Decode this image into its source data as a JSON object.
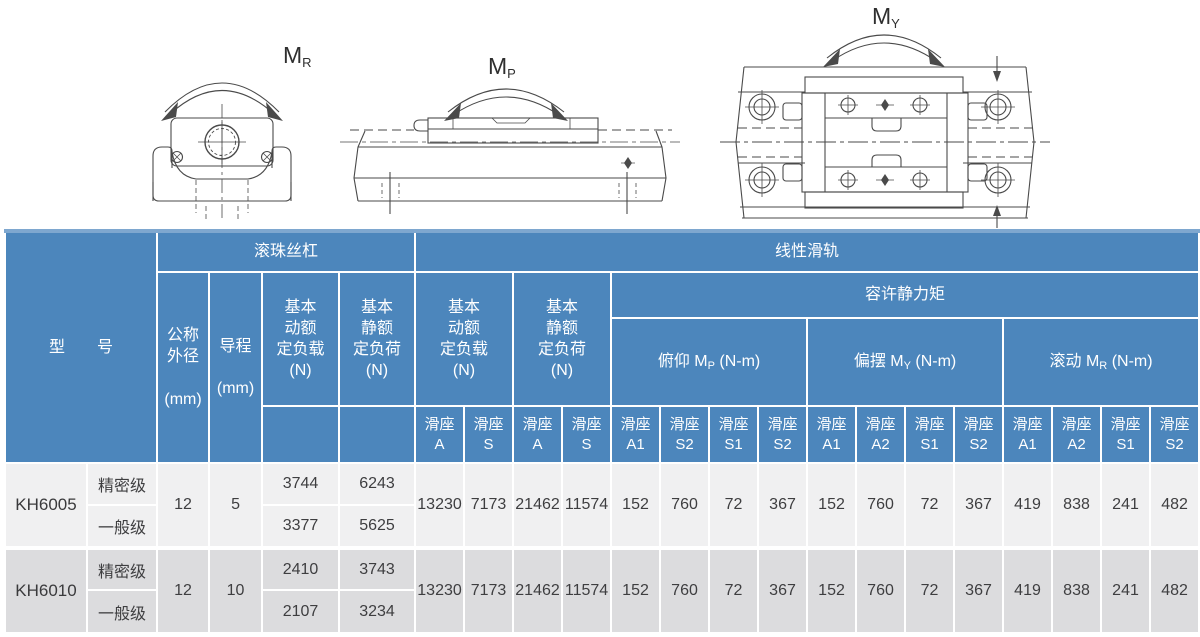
{
  "diagrams": {
    "mr": {
      "prefix": "M",
      "sub": "R"
    },
    "mp": {
      "prefix": "M",
      "sub": "P"
    },
    "my": {
      "prefix": "M",
      "sub": "Y"
    }
  },
  "colors": {
    "header_blue": "#4c86bc",
    "header_top_strip": "#7ea7cf",
    "row_light_gray": "#f0f0f1",
    "row_dark_gray": "#dcdcde",
    "body_text": "#3e3e40",
    "drawing_line": "#4a4a4a"
  },
  "table": {
    "header": {
      "model": "型　　号",
      "ball_screw": "滚珠丝杠",
      "linear_guide": "线性滑轨",
      "nominal_od": "公称\n外径\n\n(mm)",
      "lead": "导程\n\n(mm)",
      "bs_dynamic": "基本\n动额\n定负载\n(N)",
      "bs_static": "基本\n静额\n定负荷\n(N)",
      "lg_dynamic": "基本\n动额\n定负载\n(N)",
      "lg_static": "基本\n静额\n定负荷\n(N)",
      "static_moment": "容许静力矩",
      "moment_groups": [
        {
          "prefix": "俯仰 M",
          "sub": "P",
          "suffix": " (N-m)"
        },
        {
          "prefix": "偏摆 M",
          "sub": "Y",
          "suffix": " (N-m)"
        },
        {
          "prefix": "滚动 M",
          "sub": "R",
          "suffix": " (N-m)"
        }
      ],
      "slide_cols": [
        {
          "top": "滑座",
          "bottom": "A"
        },
        {
          "top": "滑座",
          "bottom": "S"
        },
        {
          "top": "滑座",
          "bottom": "A"
        },
        {
          "top": "滑座",
          "bottom": "S"
        },
        {
          "top": "滑座",
          "bottom": "A1"
        },
        {
          "top": "滑座",
          "bottom": "S2"
        },
        {
          "top": "滑座",
          "bottom": "S1"
        },
        {
          "top": "滑座",
          "bottom": "S2"
        },
        {
          "top": "滑座",
          "bottom": "A1"
        },
        {
          "top": "滑座",
          "bottom": "A2"
        },
        {
          "top": "滑座",
          "bottom": "S1"
        },
        {
          "top": "滑座",
          "bottom": "S2"
        },
        {
          "top": "滑座",
          "bottom": "A1"
        },
        {
          "top": "滑座",
          "bottom": "A2"
        },
        {
          "top": "滑座",
          "bottom": "S1"
        },
        {
          "top": "滑座",
          "bottom": "S2"
        }
      ]
    },
    "rows": [
      {
        "model": "KH6005",
        "od": "12",
        "lead": "5",
        "grades": [
          {
            "grade": "精密级",
            "bs_dyn": "3744",
            "bs_stat": "6243"
          },
          {
            "grade": "一般级",
            "bs_dyn": "3377",
            "bs_stat": "5625"
          }
        ],
        "shared": [
          "13230",
          "7173",
          "21462",
          "11574",
          "152",
          "760",
          "72",
          "367",
          "152",
          "760",
          "72",
          "367",
          "419",
          "838",
          "241",
          "482"
        ]
      },
      {
        "model": "KH6010",
        "od": "12",
        "lead": "10",
        "grades": [
          {
            "grade": "精密级",
            "bs_dyn": "2410",
            "bs_stat": "3743"
          },
          {
            "grade": "一般级",
            "bs_dyn": "2107",
            "bs_stat": "3234"
          }
        ],
        "shared": [
          "13230",
          "7173",
          "21462",
          "11574",
          "152",
          "760",
          "72",
          "367",
          "152",
          "760",
          "72",
          "367",
          "419",
          "838",
          "241",
          "482"
        ]
      }
    ]
  }
}
